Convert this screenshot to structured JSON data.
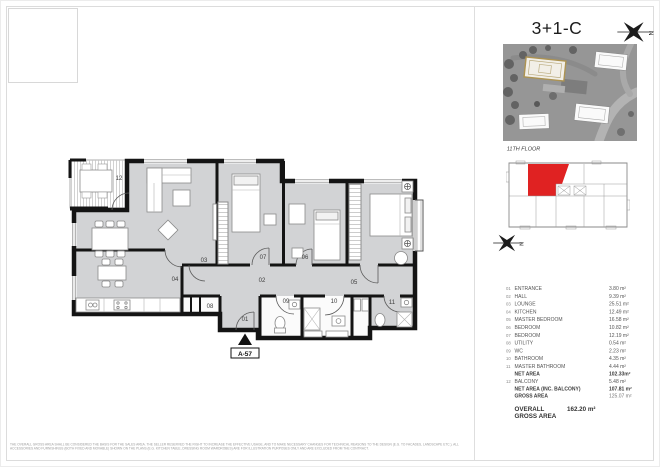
{
  "page": {
    "title": "3+1-C",
    "floor_label": "11TH FLOOR",
    "unit_code": "A-57",
    "north_letter": "N"
  },
  "colors": {
    "unit_red": "#e02222",
    "floor_fill": "#d2d3d5",
    "wall": "#141414",
    "highlight_building_outline": "#ad9352"
  },
  "legend": {
    "rows": [
      {
        "no": "01",
        "name": "ENTRANCE",
        "area": "3.80 m²"
      },
      {
        "no": "02",
        "name": "HALL",
        "area": "9.39 m²"
      },
      {
        "no": "03",
        "name": "LOUNGE",
        "area": "25.51 m²"
      },
      {
        "no": "04",
        "name": "KITCHEN",
        "area": "12.49 m²"
      },
      {
        "no": "05",
        "name": "MASTER BEDROOM",
        "area": "16.58 m²"
      },
      {
        "no": "06",
        "name": "BEDROOM",
        "area": "10.82 m²"
      },
      {
        "no": "07",
        "name": "BEDROOM",
        "area": "12.19 m²"
      },
      {
        "no": "08",
        "name": "UTILITY",
        "area": "0.54 m²"
      },
      {
        "no": "09",
        "name": "WC",
        "area": "2.23 m²"
      },
      {
        "no": "10",
        "name": "BATHROOM",
        "area": "4.35 m²"
      },
      {
        "no": "11",
        "name": "MASTER BATHROOM",
        "area": "4.44 m²"
      }
    ],
    "net_area": {
      "name": "NET AREA",
      "area": "102.33m²"
    },
    "balcony_row": {
      "no": "12",
      "name": "BALCONY",
      "area": "5.48 m²"
    },
    "net_area_inc": {
      "name": "NET AREA (INC. BALCONY)",
      "area": "107.81 m²"
    },
    "gross_area": {
      "name": "GROSS AREA",
      "area": "125.07 m²"
    },
    "overall": {
      "name": "OVERALL GROSS AREA",
      "area": "162.20 m²"
    }
  },
  "disclaimer": "THE OVERALL GROSS AREA SHALL BE CONSIDERED THE BASIS FOR THE SALES AREA. THE SELLER RESERVED THE RIGHT TO INCREASE THE EFFECTIVE USAGE, AND TO MAKE NECESSARY CHANGES FOR TECHNICAL REASONS TO THE DESIGN (E.G. TO FACADES, LANDSCAPE ETC.). ALL ACCESSORIES AND FURNISHINGS (BOTH FIXED AND MOVABLE) SHOWN ON THE PLANS (E.G. KITCHEN TABLE, DRESSING ROOM WARDROBES) ARE FOR ILLUSTRATION PURPOSES ONLY AND ARE EXCLUDED FROM THE CONTRACT."
}
